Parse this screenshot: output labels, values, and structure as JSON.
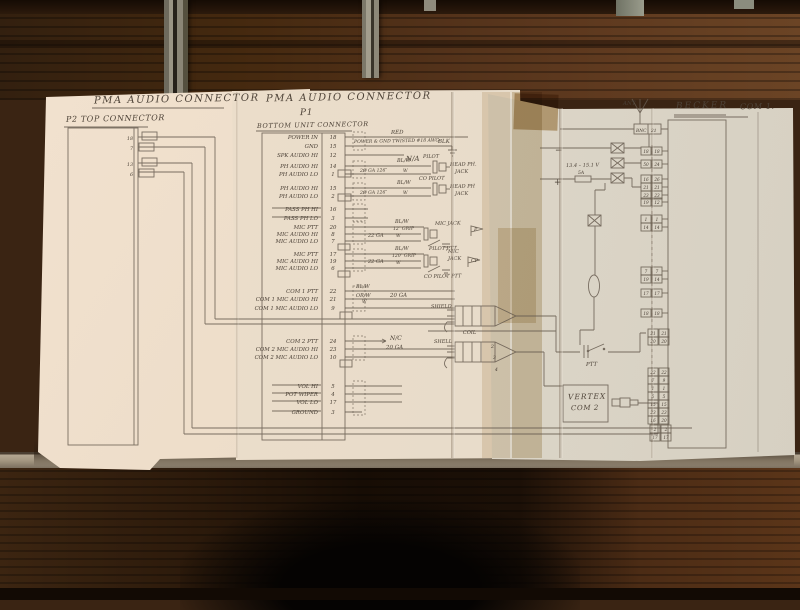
{
  "titles": {
    "pma_p2_title": "PMA AUDIO CONNECTOR",
    "p2_subtitle": "P2 TOP CONNECTOR",
    "pma_p1_title": "PMA AUDIO CONNECTOR",
    "p1_designator": "P1",
    "p1_subtitle": "BOTTOM UNIT CONNECTOR",
    "becker_title": "BECKER",
    "becker_com": "COM 1.",
    "vertex_line1": "VERTEX",
    "vertex_line2": "COM 2",
    "ant_label": "ANT"
  },
  "colors": {
    "paper": "#e8dcca",
    "pencil": "#655a4e",
    "ink_text": "#4a4036",
    "wood": "#4a2c16",
    "tape": "#c8ae85"
  },
  "p2_pins": [
    {
      "n": "18",
      "y": 140
    },
    {
      "n": "7",
      "y": 150
    },
    {
      "n": "13",
      "y": 166
    },
    {
      "n": "6",
      "y": 176
    }
  ],
  "p1_rows": [
    {
      "label": "POWER IN",
      "pin": "18",
      "y": 137,
      "end": 468,
      "struck": false
    },
    {
      "label": "GND",
      "pin": "15",
      "y": 146,
      "end": 446,
      "struck": false
    },
    {
      "label": "SPK AUDIO HI",
      "pin": "12",
      "y": 155,
      "end": 404,
      "struck": false
    },
    {
      "label": "PH AUDIO HI",
      "pin": "14",
      "y": 166,
      "end": 431,
      "struck": false
    },
    {
      "label": "PH AUDIO LO",
      "pin": "1",
      "y": 174,
      "end": 431,
      "struck": false
    },
    {
      "label": "PH AUDIO HI",
      "pin": "15",
      "y": 188,
      "end": 431,
      "struck": false
    },
    {
      "label": "PH AUDIO LO",
      "pin": "2",
      "y": 196,
      "end": 431,
      "struck": false
    },
    {
      "label": "PASS PH HI",
      "pin": "16",
      "y": 209,
      "end": 368,
      "struck": true
    },
    {
      "label": "PASS PH LO",
      "pin": "3",
      "y": 218,
      "end": 368,
      "struck": true
    },
    {
      "label": "MIC PTT",
      "pin": "20",
      "y": 227,
      "end": 424,
      "struck": false
    },
    {
      "label": "MIC AUDIO HI",
      "pin": "8",
      "y": 234,
      "end": 421,
      "struck": false
    },
    {
      "label": "MIC AUDIO LO",
      "pin": "7",
      "y": 241,
      "end": 421,
      "struck": false
    },
    {
      "label": "MIC PTT",
      "pin": "17",
      "y": 254,
      "end": 424,
      "struck": false
    },
    {
      "label": "MIC AUDIO HI",
      "pin": "19",
      "y": 261,
      "end": 421,
      "struck": false
    },
    {
      "label": "MIC AUDIO LO",
      "pin": "6",
      "y": 268,
      "end": 421,
      "struck": false
    },
    {
      "label": "COM 1 PTT",
      "pin": "22",
      "y": 291,
      "end": 455,
      "struck": false
    },
    {
      "label": "COM 1 MIC AUDIO HI",
      "pin": "21",
      "y": 299,
      "end": 455,
      "struck": false
    },
    {
      "label": "COM 1 MIC AUDIO LO",
      "pin": "9",
      "y": 308,
      "end": 455,
      "struck": false
    },
    {
      "label": "COM 2 PTT",
      "pin": "24",
      "y": 341,
      "end": 386,
      "struck": false
    },
    {
      "label": "COM 2 MIC AUDIO HI",
      "pin": "23",
      "y": 349,
      "end": 455,
      "struck": false
    },
    {
      "label": "COM 2 MIC AUDIO LO",
      "pin": "10",
      "y": 357,
      "end": 455,
      "struck": false
    },
    {
      "label": "VOL HI",
      "pin": "5",
      "y": 386,
      "end": 402,
      "struck": true
    },
    {
      "label": "POT WIPER",
      "pin": "4",
      "y": 394,
      "end": 402,
      "struck": true
    },
    {
      "label": "VOL LO",
      "pin": "17",
      "y": 402,
      "end": 402,
      "struck": true
    },
    {
      "label": "GROUND",
      "pin": "3",
      "y": 412,
      "end": 362,
      "struck": true
    }
  ],
  "becker": {
    "bnc": "BNC",
    "bnc_pin": "21",
    "minus": "−",
    "plus": "+",
    "voltage": "13.4 – 15.1 V",
    "fuse": "5A",
    "pin_groups": [
      {
        "x": 641,
        "rows": [
          {
            "y": 151,
            "l": "18",
            "r": "18"
          },
          {
            "y": 164,
            "l": "50",
            "r": "24"
          }
        ]
      },
      {
        "x": 641,
        "rows": [
          {
            "y": 179,
            "l": "16",
            "r": "26"
          },
          {
            "y": 187,
            "l": "21",
            "r": "21"
          },
          {
            "y": 195,
            "l": "23",
            "r": "23"
          },
          {
            "y": 202,
            "l": "19",
            "r": "12"
          }
        ]
      },
      {
        "x": 641,
        "rows": [
          {
            "y": 219,
            "l": "1",
            "r": "1"
          },
          {
            "y": 227,
            "l": "14",
            "r": "14"
          }
        ]
      },
      {
        "x": 641,
        "rows": [
          {
            "y": 271,
            "l": "7",
            "r": "7"
          },
          {
            "y": 279,
            "l": "19",
            "r": "14"
          }
        ]
      },
      {
        "x": 641,
        "rows": [
          {
            "y": 293,
            "l": "17",
            "r": "17"
          }
        ]
      },
      {
        "x": 641,
        "rows": [
          {
            "y": 313,
            "l": "18",
            "r": "18"
          }
        ]
      },
      {
        "x": 648,
        "rows": [
          {
            "y": 333,
            "l": "21",
            "r": "21"
          },
          {
            "y": 341,
            "l": "20",
            "r": "20"
          }
        ]
      },
      {
        "x": 648,
        "rows": [
          {
            "y": 372,
            "l": "22",
            "r": "22"
          },
          {
            "y": 380,
            "l": "7",
            "r": "9"
          },
          {
            "y": 388,
            "l": "1",
            "r": "1"
          },
          {
            "y": 396,
            "l": "5",
            "r": "5"
          },
          {
            "y": 404,
            "l": "15",
            "r": "15"
          },
          {
            "y": 412,
            "l": "23",
            "r": "23"
          },
          {
            "y": 420,
            "l": "16",
            "r": "20"
          }
        ]
      },
      {
        "x": 650,
        "rows": [
          {
            "y": 429,
            "l": "2",
            "r": "2"
          },
          {
            "y": 437,
            "l": "17",
            "r": "17"
          }
        ]
      }
    ]
  },
  "wire_labels": [
    {
      "t": "RED",
      "x": 391,
      "y": 134,
      "s": 5.5
    },
    {
      "t": "POWER & GND TWISTED #18 AWG",
      "x": 354,
      "y": 143,
      "s": 4.6
    },
    {
      "t": "BLK",
      "x": 438,
      "y": 143,
      "s": 5.5
    },
    {
      "t": "N/A",
      "x": 406,
      "y": 161,
      "s": 7
    },
    {
      "t": "BL/W",
      "x": 397,
      "y": 162,
      "s": 5
    },
    {
      "t": "PILOT",
      "x": 423,
      "y": 158,
      "s": 5
    },
    {
      "t": "HEAD PH.",
      "x": 450,
      "y": 166,
      "s": 5
    },
    {
      "t": "JACK",
      "x": 455,
      "y": 173,
      "s": 5
    },
    {
      "t": "2Ø GA 126″",
      "x": 360,
      "y": 172,
      "s": 4.6
    },
    {
      "t": "W",
      "x": 403,
      "y": 172,
      "s": 4.6
    },
    {
      "t": "BL/W",
      "x": 397,
      "y": 184,
      "s": 5
    },
    {
      "t": "CO PILOT",
      "x": 419,
      "y": 180,
      "s": 5
    },
    {
      "t": "HEAD PH",
      "x": 450,
      "y": 188,
      "s": 5
    },
    {
      "t": "JACK",
      "x": 455,
      "y": 195,
      "s": 5
    },
    {
      "t": "2Ø GA 126″",
      "x": 360,
      "y": 194,
      "s": 4.6
    },
    {
      "t": "W",
      "x": 403,
      "y": 194,
      "s": 4.6
    },
    {
      "t": "BL/W",
      "x": 395,
      "y": 223,
      "s": 5
    },
    {
      "t": "12″ GRIP",
      "x": 393,
      "y": 230,
      "s": 4.6
    },
    {
      "t": "22 GA",
      "x": 368,
      "y": 237,
      "s": 5
    },
    {
      "t": "W",
      "x": 396,
      "y": 237,
      "s": 4.6
    },
    {
      "t": "MIC JACK",
      "x": 435,
      "y": 225,
      "s": 5
    },
    {
      "t": "PILOT PTT",
      "x": 429,
      "y": 250,
      "s": 5
    },
    {
      "t": "BL/W",
      "x": 395,
      "y": 250,
      "s": 5
    },
    {
      "t": "120″ GRIP",
      "x": 392,
      "y": 257,
      "s": 4.6
    },
    {
      "t": "22 GA",
      "x": 368,
      "y": 263,
      "s": 5
    },
    {
      "t": "W",
      "x": 396,
      "y": 264,
      "s": 4.6
    },
    {
      "t": "MIC",
      "x": 448,
      "y": 253,
      "s": 5
    },
    {
      "t": "JACK",
      "x": 448,
      "y": 260,
      "s": 5
    },
    {
      "t": "CO PILOT PTT",
      "x": 424,
      "y": 278,
      "s": 5
    },
    {
      "t": "BL/W",
      "x": 356,
      "y": 288,
      "s": 5
    },
    {
      "t": "OR/W",
      "x": 356,
      "y": 297,
      "s": 5
    },
    {
      "t": "20 GA",
      "x": 390,
      "y": 297,
      "s": 5.5
    },
    {
      "t": "W",
      "x": 362,
      "y": 303,
      "s": 4.6
    },
    {
      "t": "SHIELD",
      "x": 431,
      "y": 308,
      "s": 5
    },
    {
      "t": "N/C",
      "x": 390,
      "y": 340,
      "s": 6
    },
    {
      "t": "20 GA",
      "x": 386,
      "y": 349,
      "s": 5.5
    },
    {
      "t": "SHELL",
      "x": 434,
      "y": 343,
      "s": 5
    },
    {
      "t": "2",
      "x": 491,
      "y": 348,
      "s": 4.6
    },
    {
      "t": "3",
      "x": 493,
      "y": 359,
      "s": 4.6
    },
    {
      "t": "4",
      "x": 495,
      "y": 371,
      "s": 4.6
    },
    {
      "t": "COIL",
      "x": 463,
      "y": 334,
      "s": 5
    },
    {
      "t": "PTT",
      "x": 586,
      "y": 366,
      "s": 5.5
    },
    {
      "t": "−",
      "x": 555,
      "y": 153,
      "s": 9
    },
    {
      "t": "+",
      "x": 554,
      "y": 185,
      "s": 9
    },
    {
      "t": "13.4 – 15.1 V",
      "x": 566,
      "y": 167,
      "s": 5
    },
    {
      "t": "5A",
      "x": 578,
      "y": 174,
      "s": 4.6
    },
    {
      "t": "BNC",
      "x": 636,
      "y": 132,
      "s": 4.4
    },
    {
      "t": "21",
      "x": 651,
      "y": 132,
      "s": 4.4
    },
    {
      "t": "ANT",
      "x": 623,
      "y": 105,
      "s": 5.5
    }
  ],
  "flags": [
    {
      "t": "P",
      "x": 473,
      "y": 232
    },
    {
      "t": "CP",
      "x": 470,
      "y": 263
    }
  ]
}
